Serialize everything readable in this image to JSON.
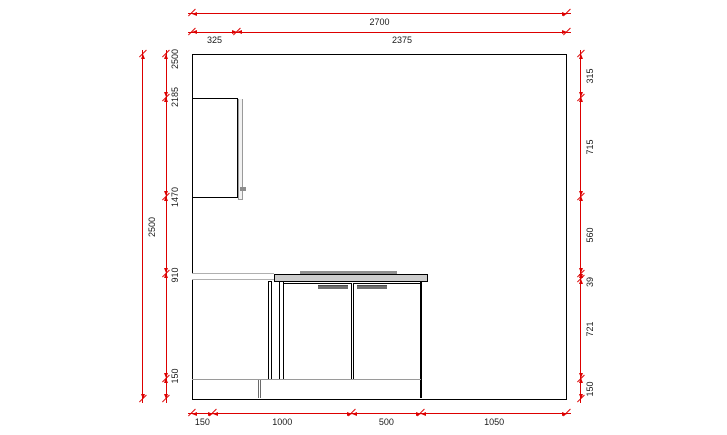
{
  "drawing": {
    "type": "kitchen-elevation",
    "units": "mm",
    "room": {
      "width_mm": 2700,
      "height_mm": 2500
    },
    "colors": {
      "dimension_line": "#dd0000",
      "dimension_text": "#1a1a1a",
      "outline": "#000000",
      "worktop_fill": "#cdcdcd",
      "detail_gray": "#8f8f8f",
      "background": "#ffffff"
    },
    "objects": [
      {
        "name": "wall-cabinet"
      },
      {
        "name": "worktop-left-run"
      },
      {
        "name": "base-cabinet-two-door"
      },
      {
        "name": "worktop"
      },
      {
        "name": "plinth"
      }
    ],
    "dimension_chains": [
      {
        "id": "top-overall",
        "orient": "h",
        "line_px": 13,
        "ticks_mm": [
          0,
          2700
        ],
        "labels": [
          {
            "text": "2700",
            "at_mm": 1350
          }
        ]
      },
      {
        "id": "top-sub",
        "orient": "h",
        "line_px": 31.5,
        "ticks_mm": [
          0,
          325,
          2700
        ],
        "labels": [
          {
            "text": "325",
            "at_mm": 162
          },
          {
            "text": "2375",
            "at_mm": 1512
          }
        ]
      },
      {
        "id": "bottom",
        "orient": "h",
        "line_px": 413,
        "ticks_mm": [
          0,
          150,
          1150,
          1650,
          2700
        ],
        "labels": [
          {
            "text": "150",
            "at_mm": 75
          },
          {
            "text": "1000",
            "at_mm": 650
          },
          {
            "text": "500",
            "at_mm": 1400
          },
          {
            "text": "1050",
            "at_mm": 2175
          }
        ]
      },
      {
        "id": "left-overall",
        "orient": "v",
        "line_px": 142,
        "ticks_mm": [
          0,
          2500
        ],
        "labels": [
          {
            "text": "2500",
            "at_mm": 1250
          }
        ]
      },
      {
        "id": "left-heights",
        "orient": "v",
        "line_px": 165.5,
        "ticks_mm": [
          0,
          150,
          910,
          1470,
          2185,
          2500
        ],
        "labels": [
          {
            "text": "150",
            "at_mm": 165
          },
          {
            "text": "910",
            "at_mm": 900
          },
          {
            "text": "1470",
            "at_mm": 1465
          },
          {
            "text": "2185",
            "at_mm": 2185
          },
          {
            "text": "2500",
            "at_mm": 2462
          }
        ]
      },
      {
        "id": "right-heights",
        "orient": "v",
        "line_px": 580,
        "ticks_mm": [
          0,
          150,
          871,
          910,
          1470,
          2185,
          2500
        ],
        "labels": [
          {
            "text": "315",
            "at_mm": 2342
          },
          {
            "text": "715",
            "at_mm": 1827
          },
          {
            "text": "560",
            "at_mm": 1190
          },
          {
            "text": "39",
            "at_mm": 848
          },
          {
            "text": "721",
            "at_mm": 510
          },
          {
            "text": "150",
            "at_mm": 75
          }
        ]
      }
    ]
  }
}
